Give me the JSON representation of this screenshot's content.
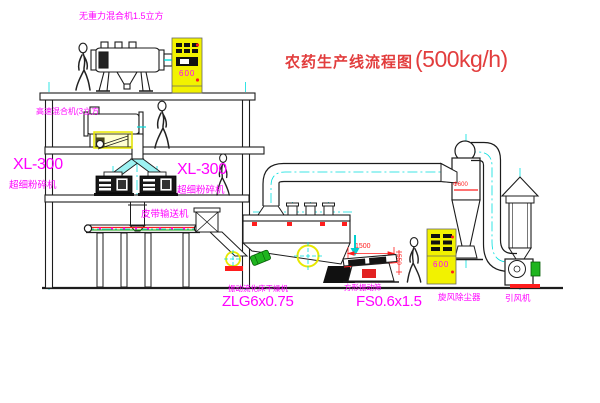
{
  "title": {
    "name": "农药生产线流程图",
    "capacity": "(500kg/h)"
  },
  "labels": {
    "top_mixer": "无重力混合机1.5立方",
    "hs_mixer": "高速混合机(3立方",
    "xl300_left": "XL-300",
    "mill_left": "超细粉碎机",
    "xl300_right": "XL-300",
    "mill_right": "超细粉碎机",
    "belt_conveyor": "皮带输送机",
    "dryer": "振动流化床干燥机",
    "dryer_model": "ZLG6x0.75",
    "sieve": "方形振动筛",
    "sieve_model": "FS0.6x1.5",
    "cyclone": "旋风除尘器",
    "fan": "引风机"
  },
  "dimensions": {
    "sieve_length": "1500",
    "sieve_height": "550",
    "cyclone_diameter": "Φ600"
  },
  "cabinets": {
    "cabinet_a": "600",
    "cabinet_b": "600"
  },
  "colors": {
    "magenta": "#ff00ff",
    "title_red": "#e23d3d",
    "red": "#ff1d1d",
    "yellow": "#f2f200",
    "cyan": "#00dede",
    "green": "#1fb51f",
    "ink": "#1c1c1c"
  }
}
